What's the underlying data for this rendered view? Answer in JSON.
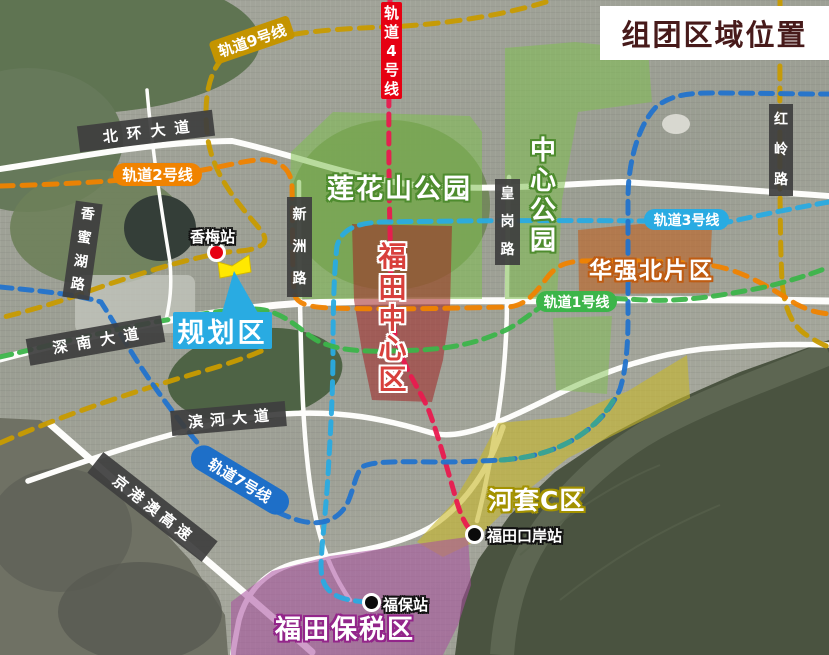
{
  "title": "组团区域位置",
  "rails": {
    "line9": {
      "label": "轨道9号线",
      "color": "#C49400"
    },
    "line4": {
      "label": "轨道4号线",
      "color": "#E60012"
    },
    "line2": {
      "label": "轨道2号线",
      "color": "#F08300"
    },
    "line3": {
      "label": "轨道3号线",
      "color": "#29ABE2"
    },
    "line1": {
      "label": "轨道1号线",
      "color": "#3CB54A"
    },
    "line7": {
      "label": "轨道7号线",
      "color": "#1E6FC8"
    }
  },
  "roads": {
    "beihuan": "北环大道",
    "xiangmihu": "香蜜湖路",
    "xinzhou": "新洲路",
    "huanggang": "皇岗路",
    "hongling": "红岭路",
    "shennan": "深南大道",
    "binhe": "滨河大道",
    "jinggangao": "京港澳高速"
  },
  "areas": {
    "lianhuashan": {
      "label": "莲花山公园",
      "color": "#7FC050"
    },
    "zhongxinpark": {
      "label": "中心公园",
      "color": "#7FC050"
    },
    "futiancenter": {
      "label": "福田中心区",
      "color": "#B03030"
    },
    "huaqiangbei": {
      "label": "华强北片区",
      "color": "#C06020"
    },
    "hetaoc": {
      "label": "河套C区",
      "color": "#C8B828"
    },
    "baoshui": {
      "label": "福田保税区",
      "color": "#A94FA0"
    },
    "planning": {
      "label": "规划区",
      "color": "#29ABE2",
      "site_color": "#FFE800"
    }
  },
  "stations": {
    "xiangmei": {
      "label": "香梅站",
      "marker_color": "#E60012"
    },
    "futiankouan": {
      "label": "福田口岸站",
      "marker_color": "#0B0B0B"
    },
    "fubao": {
      "label": "福保站",
      "marker_color": "#0B0B0B"
    }
  }
}
